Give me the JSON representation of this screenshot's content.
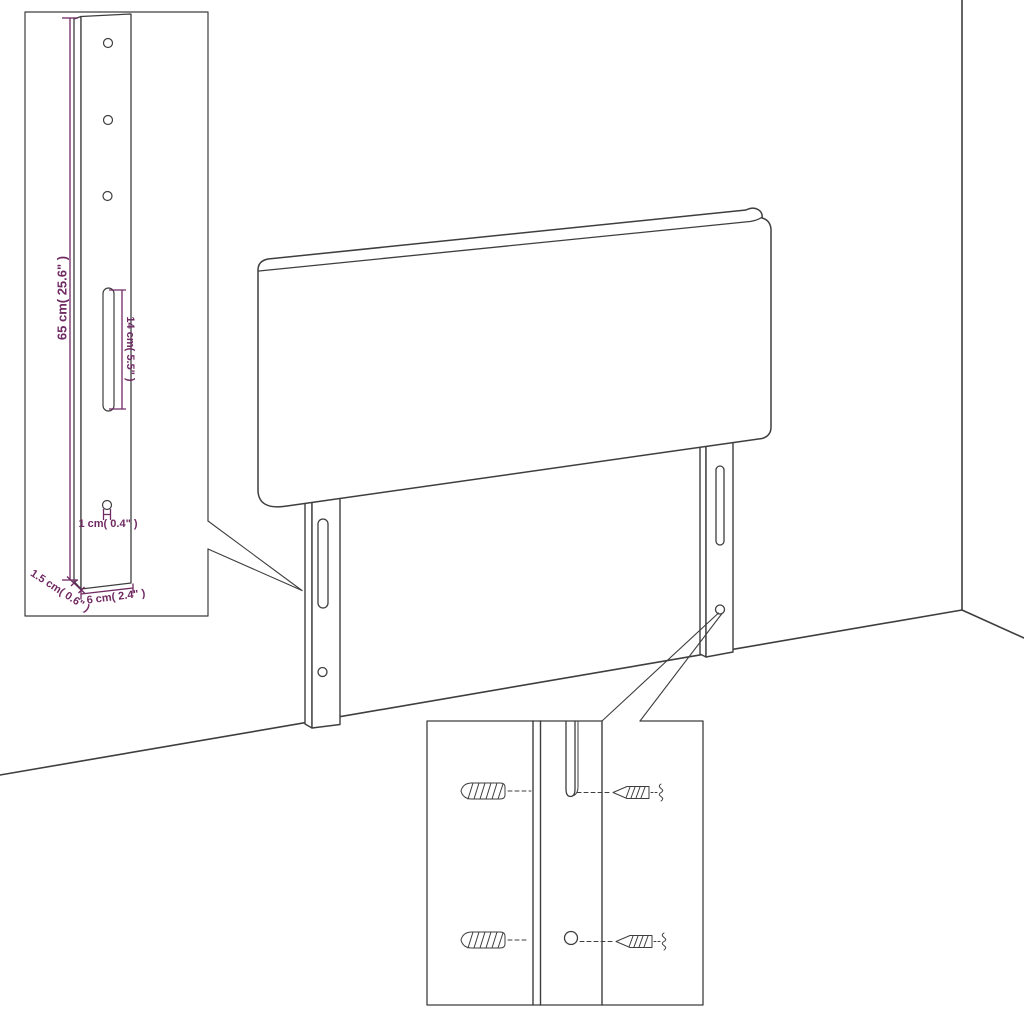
{
  "colors": {
    "line": "#3e3e3e",
    "dimension": "#702a63",
    "background": "#ffffff"
  },
  "labels": {
    "bracket_height": "65 cm( 25.6\" )",
    "slot_length": "14 cm( 5.5\" )",
    "hole_diameter": "1 cm( 0.4\" )",
    "bracket_thickness": "1.5 cm( 0.6\" )",
    "bracket_width": "6 cm( 2.4\" )"
  }
}
